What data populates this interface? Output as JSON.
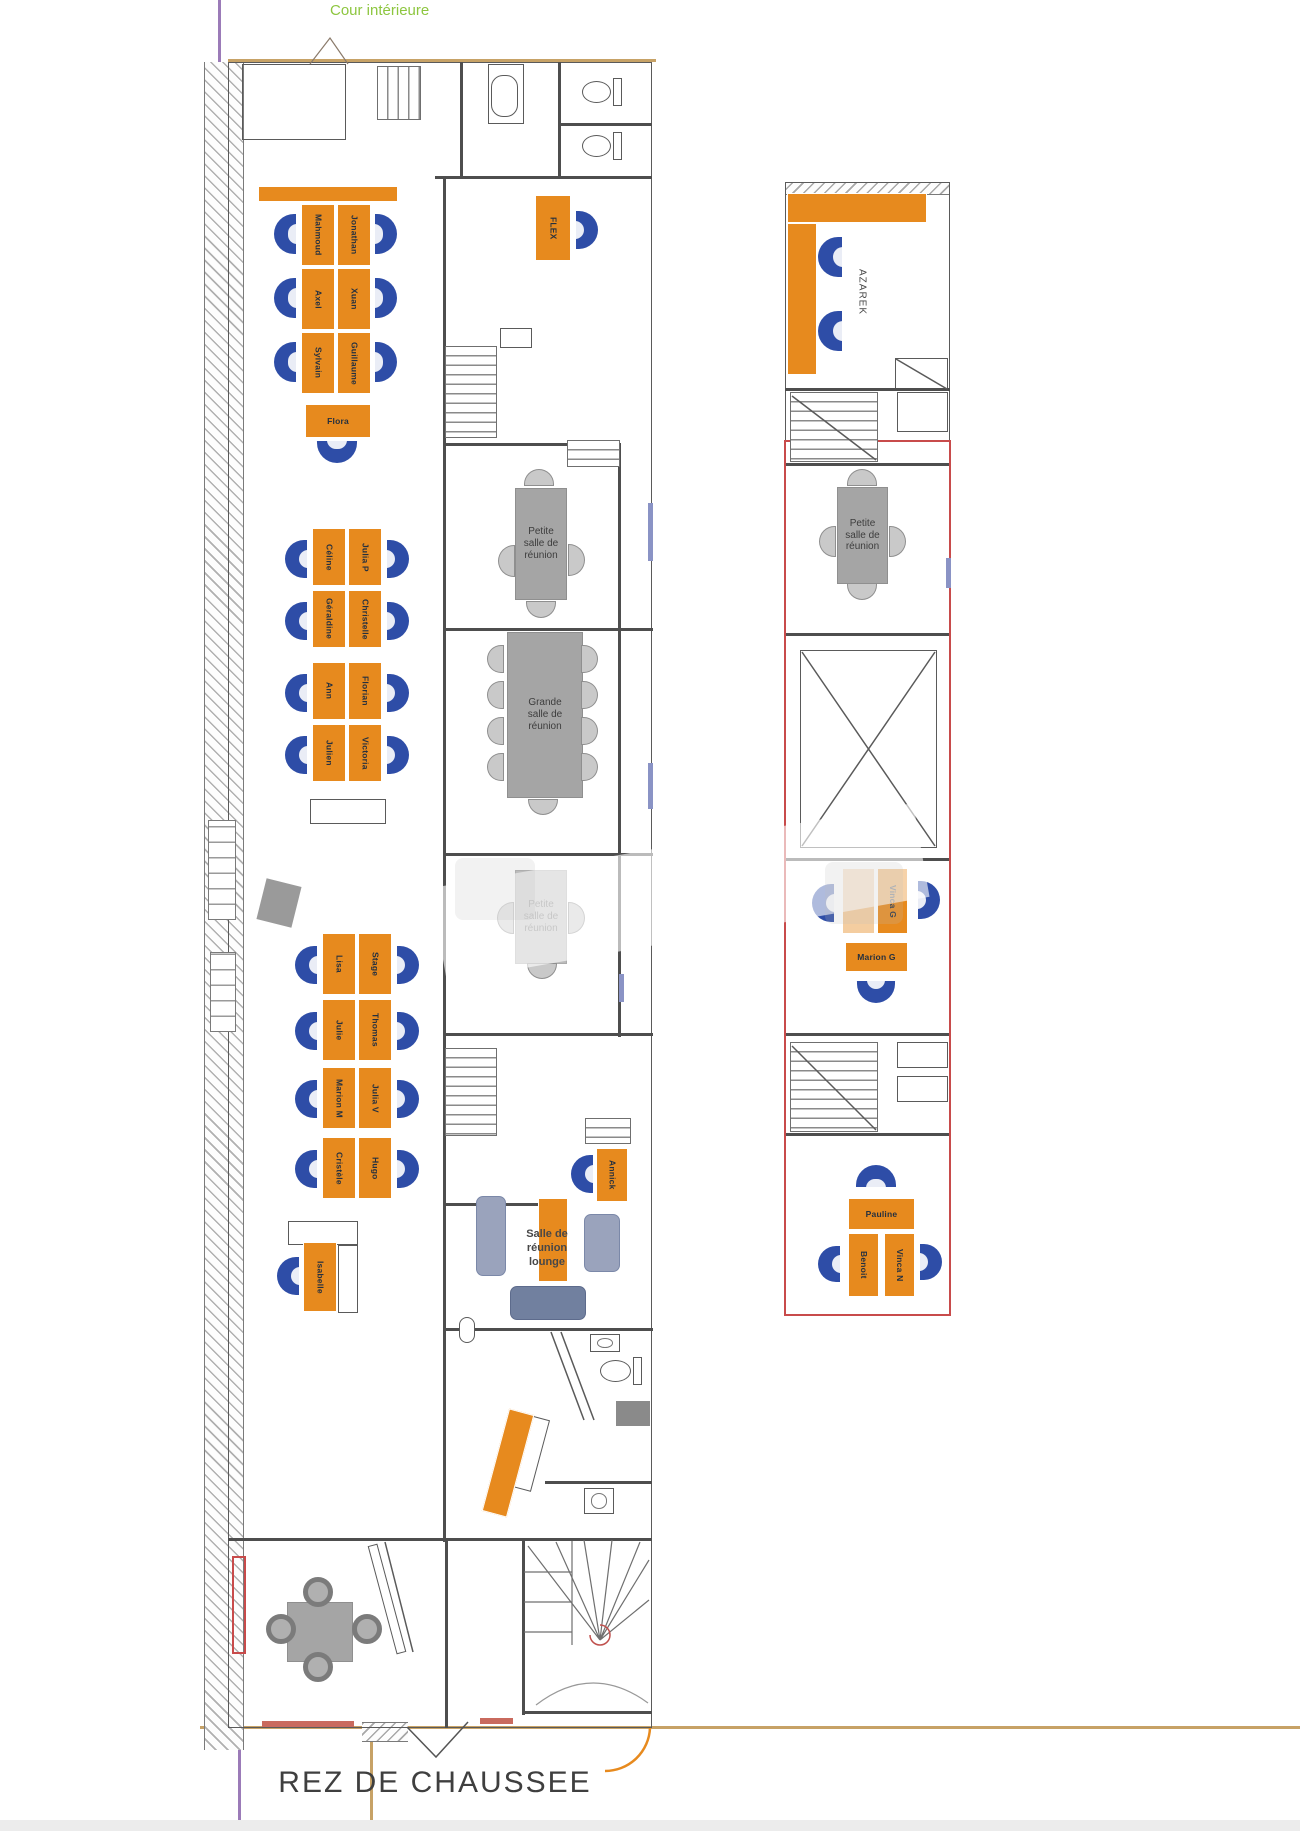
{
  "labels": {
    "courtyard": "Cour intérieure",
    "floor_title": "REZ DE CHAUSSEE"
  },
  "colors": {
    "desk_orange": "#E78A1E",
    "chair_blue": "#2E4DA7",
    "table_gray": "#A5A5A5",
    "wall": "#4E4E4E",
    "red_wall": "#C84B4B",
    "courtyard_green": "#8DC63F",
    "ground_tan": "#C7A266",
    "boundary_purple": "#9B7BB8"
  },
  "room_labels": [
    {
      "text": "Salle de\nréunion\nlounge",
      "x": 497,
      "y": 1212,
      "w": 100,
      "h": 74,
      "size": 11,
      "vert": false,
      "name": "room-label-lounge"
    },
    {
      "text": "AZAREK",
      "x": 850,
      "y": 240,
      "w": 22,
      "h": 104,
      "size": 10,
      "vert": true,
      "name": "room-label-azarek"
    }
  ],
  "desks": [
    {
      "label": "",
      "x": 258,
      "y": 186,
      "w": 140,
      "h": 16,
      "o": "h"
    },
    {
      "label": "Mahmoud",
      "x": 301,
      "y": 204,
      "w": 34,
      "h": 62,
      "o": "v"
    },
    {
      "label": "Jonathan",
      "x": 337,
      "y": 204,
      "w": 34,
      "h": 62,
      "o": "v"
    },
    {
      "label": "Axel",
      "x": 301,
      "y": 268,
      "w": 34,
      "h": 62,
      "o": "v"
    },
    {
      "label": "Xuan",
      "x": 337,
      "y": 268,
      "w": 34,
      "h": 62,
      "o": "v"
    },
    {
      "label": "Sylvain",
      "x": 301,
      "y": 332,
      "w": 34,
      "h": 62,
      "o": "v"
    },
    {
      "label": "Guillaume",
      "x": 337,
      "y": 332,
      "w": 34,
      "h": 62,
      "o": "v"
    },
    {
      "label": "Flora",
      "x": 305,
      "y": 404,
      "w": 66,
      "h": 34,
      "o": "h"
    },
    {
      "label": "Céline",
      "x": 312,
      "y": 528,
      "w": 34,
      "h": 58,
      "o": "v"
    },
    {
      "label": "Julia P",
      "x": 348,
      "y": 528,
      "w": 34,
      "h": 58,
      "o": "v"
    },
    {
      "label": "Géraldine",
      "x": 312,
      "y": 590,
      "w": 34,
      "h": 58,
      "o": "v"
    },
    {
      "label": "Christelle",
      "x": 348,
      "y": 590,
      "w": 34,
      "h": 58,
      "o": "v"
    },
    {
      "label": "Ann",
      "x": 312,
      "y": 662,
      "w": 34,
      "h": 58,
      "o": "v"
    },
    {
      "label": "Florian",
      "x": 348,
      "y": 662,
      "w": 34,
      "h": 58,
      "o": "v"
    },
    {
      "label": "Julien",
      "x": 312,
      "y": 724,
      "w": 34,
      "h": 58,
      "o": "v"
    },
    {
      "label": "Victoria",
      "x": 348,
      "y": 724,
      "w": 34,
      "h": 58,
      "o": "v"
    },
    {
      "label": "Lisa",
      "x": 322,
      "y": 933,
      "w": 34,
      "h": 62,
      "o": "v"
    },
    {
      "label": "Stage",
      "x": 358,
      "y": 933,
      "w": 34,
      "h": 62,
      "o": "v"
    },
    {
      "label": "Julie",
      "x": 322,
      "y": 999,
      "w": 34,
      "h": 62,
      "o": "v"
    },
    {
      "label": "Thomas",
      "x": 358,
      "y": 999,
      "w": 34,
      "h": 62,
      "o": "v"
    },
    {
      "label": "Marion M",
      "x": 322,
      "y": 1067,
      "w": 34,
      "h": 62,
      "o": "v"
    },
    {
      "label": "Julia V",
      "x": 358,
      "y": 1067,
      "w": 34,
      "h": 62,
      "o": "v"
    },
    {
      "label": "Cristèle",
      "x": 322,
      "y": 1137,
      "w": 34,
      "h": 62,
      "o": "v"
    },
    {
      "label": "Hugo",
      "x": 358,
      "y": 1137,
      "w": 34,
      "h": 62,
      "o": "v"
    },
    {
      "label": "Isabelle",
      "x": 303,
      "y": 1242,
      "w": 34,
      "h": 70,
      "o": "v"
    },
    {
      "label": "FLEX",
      "x": 535,
      "y": 195,
      "w": 36,
      "h": 66,
      "o": "v"
    },
    {
      "label": "Annick",
      "x": 596,
      "y": 1148,
      "w": 32,
      "h": 54,
      "o": "v"
    },
    {
      "label": "",
      "x": 538,
      "y": 1198,
      "w": 30,
      "h": 84,
      "o": "v"
    },
    {
      "label": "",
      "x": 787,
      "y": 193,
      "w": 140,
      "h": 30,
      "o": "h"
    },
    {
      "label": "",
      "x": 787,
      "y": 223,
      "w": 30,
      "h": 152,
      "o": "v"
    },
    {
      "label": "",
      "x": 842,
      "y": 868,
      "w": 33,
      "h": 66,
      "o": "v",
      "faded": true
    },
    {
      "label": "Vinca G",
      "x": 877,
      "y": 868,
      "w": 31,
      "h": 66,
      "o": "v"
    },
    {
      "label": "Marion G",
      "x": 845,
      "y": 942,
      "w": 63,
      "h": 30,
      "o": "h"
    },
    {
      "label": "Pauline",
      "x": 848,
      "y": 1198,
      "w": 67,
      "h": 32,
      "o": "h"
    },
    {
      "label": "Benoit",
      "x": 848,
      "y": 1233,
      "w": 31,
      "h": 64,
      "o": "v"
    },
    {
      "label": "Vinca N",
      "x": 884,
      "y": 1233,
      "w": 31,
      "h": 64,
      "o": "v"
    },
    {
      "label": "",
      "x": 495,
      "y": 1410,
      "w": 26,
      "h": 106,
      "o": "v",
      "rot": 15
    }
  ],
  "chairs": [
    {
      "x": 274,
      "y": 214,
      "w": 22,
      "h": 40,
      "d": "l"
    },
    {
      "x": 274,
      "y": 278,
      "w": 22,
      "h": 40,
      "d": "l"
    },
    {
      "x": 274,
      "y": 342,
      "w": 22,
      "h": 40,
      "d": "l"
    },
    {
      "x": 375,
      "y": 214,
      "w": 22,
      "h": 40,
      "d": "r"
    },
    {
      "x": 375,
      "y": 278,
      "w": 22,
      "h": 40,
      "d": "r"
    },
    {
      "x": 375,
      "y": 342,
      "w": 22,
      "h": 40,
      "d": "r"
    },
    {
      "x": 317,
      "y": 441,
      "w": 40,
      "h": 22,
      "d": "d"
    },
    {
      "x": 285,
      "y": 540,
      "w": 22,
      "h": 38,
      "d": "l"
    },
    {
      "x": 285,
      "y": 602,
      "w": 22,
      "h": 38,
      "d": "l"
    },
    {
      "x": 285,
      "y": 674,
      "w": 22,
      "h": 38,
      "d": "l"
    },
    {
      "x": 285,
      "y": 736,
      "w": 22,
      "h": 38,
      "d": "l"
    },
    {
      "x": 387,
      "y": 540,
      "w": 22,
      "h": 38,
      "d": "r"
    },
    {
      "x": 387,
      "y": 602,
      "w": 22,
      "h": 38,
      "d": "r"
    },
    {
      "x": 387,
      "y": 674,
      "w": 22,
      "h": 38,
      "d": "r"
    },
    {
      "x": 387,
      "y": 736,
      "w": 22,
      "h": 38,
      "d": "r"
    },
    {
      "x": 295,
      "y": 946,
      "w": 22,
      "h": 38,
      "d": "l"
    },
    {
      "x": 295,
      "y": 1012,
      "w": 22,
      "h": 38,
      "d": "l"
    },
    {
      "x": 295,
      "y": 1080,
      "w": 22,
      "h": 38,
      "d": "l"
    },
    {
      "x": 295,
      "y": 1150,
      "w": 22,
      "h": 38,
      "d": "l"
    },
    {
      "x": 397,
      "y": 946,
      "w": 22,
      "h": 38,
      "d": "r"
    },
    {
      "x": 397,
      "y": 1012,
      "w": 22,
      "h": 38,
      "d": "r"
    },
    {
      "x": 397,
      "y": 1080,
      "w": 22,
      "h": 38,
      "d": "r"
    },
    {
      "x": 397,
      "y": 1150,
      "w": 22,
      "h": 38,
      "d": "r"
    },
    {
      "x": 277,
      "y": 1257,
      "w": 22,
      "h": 38,
      "d": "l"
    },
    {
      "x": 576,
      "y": 211,
      "w": 22,
      "h": 38,
      "d": "r"
    },
    {
      "x": 571,
      "y": 1155,
      "w": 22,
      "h": 38,
      "d": "l"
    },
    {
      "x": 818,
      "y": 237,
      "w": 24,
      "h": 40,
      "d": "l"
    },
    {
      "x": 818,
      "y": 311,
      "w": 24,
      "h": 40,
      "d": "l"
    },
    {
      "x": 812,
      "y": 884,
      "w": 22,
      "h": 38,
      "d": "l"
    },
    {
      "x": 918,
      "y": 881,
      "w": 22,
      "h": 38,
      "d": "r"
    },
    {
      "x": 857,
      "y": 981,
      "w": 38,
      "h": 22,
      "d": "d"
    },
    {
      "x": 856,
      "y": 1165,
      "w": 40,
      "h": 22,
      "d": "u"
    },
    {
      "x": 818,
      "y": 1246,
      "w": 22,
      "h": 36,
      "d": "l"
    },
    {
      "x": 920,
      "y": 1244,
      "w": 22,
      "h": 36,
      "d": "r"
    }
  ],
  "gray_chairs": [
    {
      "x": 524,
      "y": 469,
      "w": 30,
      "h": 17,
      "d": "u"
    },
    {
      "x": 498,
      "y": 545,
      "w": 17,
      "h": 32,
      "d": "l"
    },
    {
      "x": 568,
      "y": 544,
      "w": 17,
      "h": 32,
      "d": "r"
    },
    {
      "x": 526,
      "y": 601,
      "w": 30,
      "h": 17,
      "d": "d"
    },
    {
      "x": 487,
      "y": 645,
      "w": 17,
      "h": 28,
      "d": "l"
    },
    {
      "x": 487,
      "y": 681,
      "w": 17,
      "h": 28,
      "d": "l"
    },
    {
      "x": 487,
      "y": 717,
      "w": 17,
      "h": 28,
      "d": "l"
    },
    {
      "x": 487,
      "y": 753,
      "w": 17,
      "h": 28,
      "d": "l"
    },
    {
      "x": 581,
      "y": 645,
      "w": 17,
      "h": 28,
      "d": "r"
    },
    {
      "x": 581,
      "y": 681,
      "w": 17,
      "h": 28,
      "d": "r"
    },
    {
      "x": 581,
      "y": 717,
      "w": 17,
      "h": 28,
      "d": "r"
    },
    {
      "x": 581,
      "y": 753,
      "w": 17,
      "h": 28,
      "d": "r"
    },
    {
      "x": 528,
      "y": 799,
      "w": 30,
      "h": 16,
      "d": "d"
    },
    {
      "x": 497,
      "y": 902,
      "w": 17,
      "h": 32,
      "d": "l"
    },
    {
      "x": 568,
      "y": 902,
      "w": 17,
      "h": 32,
      "d": "r"
    },
    {
      "x": 527,
      "y": 963,
      "w": 30,
      "h": 16,
      "d": "d"
    },
    {
      "x": 847,
      "y": 469,
      "w": 30,
      "h": 17,
      "d": "u"
    },
    {
      "x": 819,
      "y": 526,
      "w": 17,
      "h": 31,
      "d": "l"
    },
    {
      "x": 889,
      "y": 526,
      "w": 17,
      "h": 31,
      "d": "r"
    },
    {
      "x": 847,
      "y": 583,
      "w": 30,
      "h": 17,
      "d": "d"
    }
  ],
  "round_chairs": [
    {
      "x": 303,
      "y": 1577,
      "w": 30,
      "h": 30
    },
    {
      "x": 266,
      "y": 1614,
      "w": 30,
      "h": 30
    },
    {
      "x": 352,
      "y": 1614,
      "w": 30,
      "h": 30
    },
    {
      "x": 303,
      "y": 1652,
      "w": 30,
      "h": 30
    }
  ],
  "tables": [
    {
      "label": "Petite\nsalle de\nréunion",
      "x": 515,
      "y": 488,
      "w": 52,
      "h": 112,
      "op": 1
    },
    {
      "label": "Grande\nsalle de\nréunion",
      "x": 507,
      "y": 632,
      "w": 76,
      "h": 166,
      "op": 1
    },
    {
      "label": "Petite\nsalle de\nréunion",
      "x": 515,
      "y": 870,
      "w": 52,
      "h": 94,
      "op": 0.75
    },
    {
      "label": "Petite\nsalle de\nréunion",
      "x": 837,
      "y": 487,
      "w": 51,
      "h": 97,
      "op": 1
    },
    {
      "label": "",
      "x": 287,
      "y": 1602,
      "w": 66,
      "h": 60,
      "op": 1
    }
  ],
  "sofas": [
    {
      "x": 476,
      "y": 1196,
      "w": 30,
      "h": 80,
      "dark": false
    },
    {
      "x": 584,
      "y": 1214,
      "w": 36,
      "h": 58,
      "dark": false
    },
    {
      "x": 510,
      "y": 1286,
      "w": 76,
      "h": 34,
      "dark": true
    }
  ],
  "stairs": [
    {
      "x": 445,
      "y": 346,
      "w": 52,
      "h": 92,
      "d": "h"
    },
    {
      "x": 567,
      "y": 440,
      "w": 53,
      "h": 27,
      "d": "h"
    },
    {
      "x": 445,
      "y": 1048,
      "w": 52,
      "h": 88,
      "d": "h"
    },
    {
      "x": 585,
      "y": 1118,
      "w": 46,
      "h": 26,
      "d": "h"
    },
    {
      "x": 790,
      "y": 392,
      "w": 88,
      "h": 70,
      "d": "h"
    },
    {
      "x": 790,
      "y": 1042,
      "w": 88,
      "h": 90,
      "d": "h"
    },
    {
      "x": 377,
      "y": 66,
      "w": 44,
      "h": 54,
      "d": "v"
    }
  ],
  "walls": [
    [
      435,
      176,
      217,
      3
    ],
    [
      443,
      178,
      3,
      1364
    ],
    [
      618,
      445,
      3,
      592
    ],
    [
      443,
      443,
      178,
      3
    ],
    [
      443,
      628,
      210,
      3
    ],
    [
      443,
      853,
      210,
      3
    ],
    [
      443,
      1033,
      210,
      3
    ],
    [
      443,
      1203,
      97,
      3
    ],
    [
      443,
      1328,
      210,
      3
    ],
    [
      545,
      1481,
      107,
      3
    ],
    [
      228,
      1538,
      424,
      3
    ],
    [
      445,
      1541,
      3,
      187
    ],
    [
      522,
      1538,
      3,
      177
    ],
    [
      522,
      1711,
      130,
      3
    ],
    [
      558,
      62,
      3,
      116
    ],
    [
      460,
      62,
      3,
      116
    ],
    [
      558,
      123,
      94,
      3
    ],
    [
      785,
      388,
      165,
      3
    ],
    [
      785,
      463,
      165,
      3
    ],
    [
      785,
      633,
      165,
      3
    ],
    [
      785,
      858,
      165,
      3
    ],
    [
      785,
      1033,
      165,
      3
    ],
    [
      785,
      1133,
      165,
      3
    ]
  ],
  "outlines": [
    {
      "x": 228,
      "y": 62,
      "w": 424,
      "h": 1666,
      "fill": false
    },
    {
      "x": 785,
      "y": 182,
      "w": 165,
      "h": 1133,
      "fill": false
    },
    {
      "x": 242,
      "y": 64,
      "w": 104,
      "h": 76,
      "fill": false
    },
    {
      "x": 488,
      "y": 64,
      "w": 36,
      "h": 60,
      "fill": false
    },
    {
      "x": 800,
      "y": 650,
      "w": 137,
      "h": 198,
      "fill": false
    },
    {
      "x": 895,
      "y": 358,
      "w": 53,
      "h": 32,
      "fill": false
    },
    {
      "x": 897,
      "y": 392,
      "w": 51,
      "h": 40,
      "fill": true
    },
    {
      "x": 897,
      "y": 1042,
      "w": 51,
      "h": 26,
      "fill": true
    },
    {
      "x": 897,
      "y": 1076,
      "w": 51,
      "h": 26,
      "fill": true
    },
    {
      "x": 500,
      "y": 328,
      "w": 32,
      "h": 20,
      "fill": true
    },
    {
      "x": 310,
      "y": 799,
      "w": 76,
      "h": 25,
      "fill": true
    },
    {
      "x": 288,
      "y": 1221,
      "w": 70,
      "h": 24,
      "fill": true
    },
    {
      "x": 338,
      "y": 1245,
      "w": 20,
      "h": 68,
      "fill": true
    },
    {
      "x": 509,
      "y": 1415,
      "w": 32,
      "h": 74,
      "fill": true,
      "rot": 15
    },
    {
      "x": 382,
      "y": 1543,
      "w": 10,
      "h": 112,
      "fill": true,
      "rot": -15
    }
  ],
  "hatches": [
    {
      "x": 204,
      "y": 62,
      "w": 40,
      "h": 1688,
      "o": "v"
    },
    {
      "x": 785,
      "y": 182,
      "w": 165,
      "h": 13,
      "o": "h"
    },
    {
      "x": 362,
      "y": 1722,
      "w": 46,
      "h": 20,
      "o": "h"
    }
  ],
  "red_outlines": [
    {
      "x": 784,
      "y": 440,
      "w": 167,
      "h": 876,
      "fill": false
    },
    {
      "x": 232,
      "y": 1556,
      "w": 14,
      "h": 98,
      "fill": false
    }
  ],
  "red_fills": [
    [
      262,
      1721,
      92,
      6
    ],
    [
      480,
      1718,
      33,
      6
    ]
  ],
  "tan_lines": [
    [
      228,
      59,
      428,
      3
    ],
    [
      200,
      1726,
      1100,
      3
    ],
    [
      370,
      1722,
      3,
      109
    ]
  ],
  "purple_lines": [
    [
      218,
      0,
      3,
      64
    ],
    [
      238,
      1744,
      3,
      87
    ]
  ],
  "windows": [
    [
      648,
      503,
      5,
      58
    ],
    [
      648,
      763,
      5,
      46
    ],
    [
      619,
      974,
      5,
      28
    ],
    [
      946,
      558,
      5,
      30
    ]
  ],
  "radiators": [
    [
      208,
      820,
      28,
      100
    ],
    [
      210,
      952,
      26,
      80
    ]
  ],
  "fixtures": [
    {
      "type": "pill",
      "x": 491,
      "y": 75,
      "w": 27,
      "h": 42
    },
    {
      "type": "toilet",
      "x": 582,
      "y": 78,
      "w": 40,
      "h": 28
    },
    {
      "type": "toilet",
      "x": 582,
      "y": 132,
      "w": 40,
      "h": 28
    },
    {
      "type": "toilet",
      "x": 600,
      "y": 1357,
      "w": 42,
      "h": 28
    },
    {
      "type": "sinkbox",
      "x": 590,
      "y": 1334,
      "w": 30,
      "h": 18
    },
    {
      "type": "sinkbox",
      "x": 584,
      "y": 1488,
      "w": 30,
      "h": 26
    },
    {
      "type": "appliance",
      "x": 616,
      "y": 1401,
      "w": 34,
      "h": 25
    },
    {
      "type": "pill",
      "x": 459,
      "y": 1317,
      "w": 16,
      "h": 26
    },
    {
      "type": "pillar",
      "x": 261,
      "y": 882,
      "w": 36,
      "h": 42,
      "rot": 14
    }
  ],
  "watermark": [
    {
      "x": 435,
      "y": 845,
      "w": 490,
      "h": 95,
      "band": true,
      "rot": -10
    },
    {
      "x": 455,
      "y": 858,
      "w": 80,
      "h": 62,
      "band": false
    },
    {
      "x": 825,
      "y": 862,
      "w": 78,
      "h": 62,
      "band": false
    }
  ],
  "bottom_strip": {
    "x": 0,
    "y": 1820,
    "w": 1300,
    "h": 11,
    "color": "#ececec"
  }
}
